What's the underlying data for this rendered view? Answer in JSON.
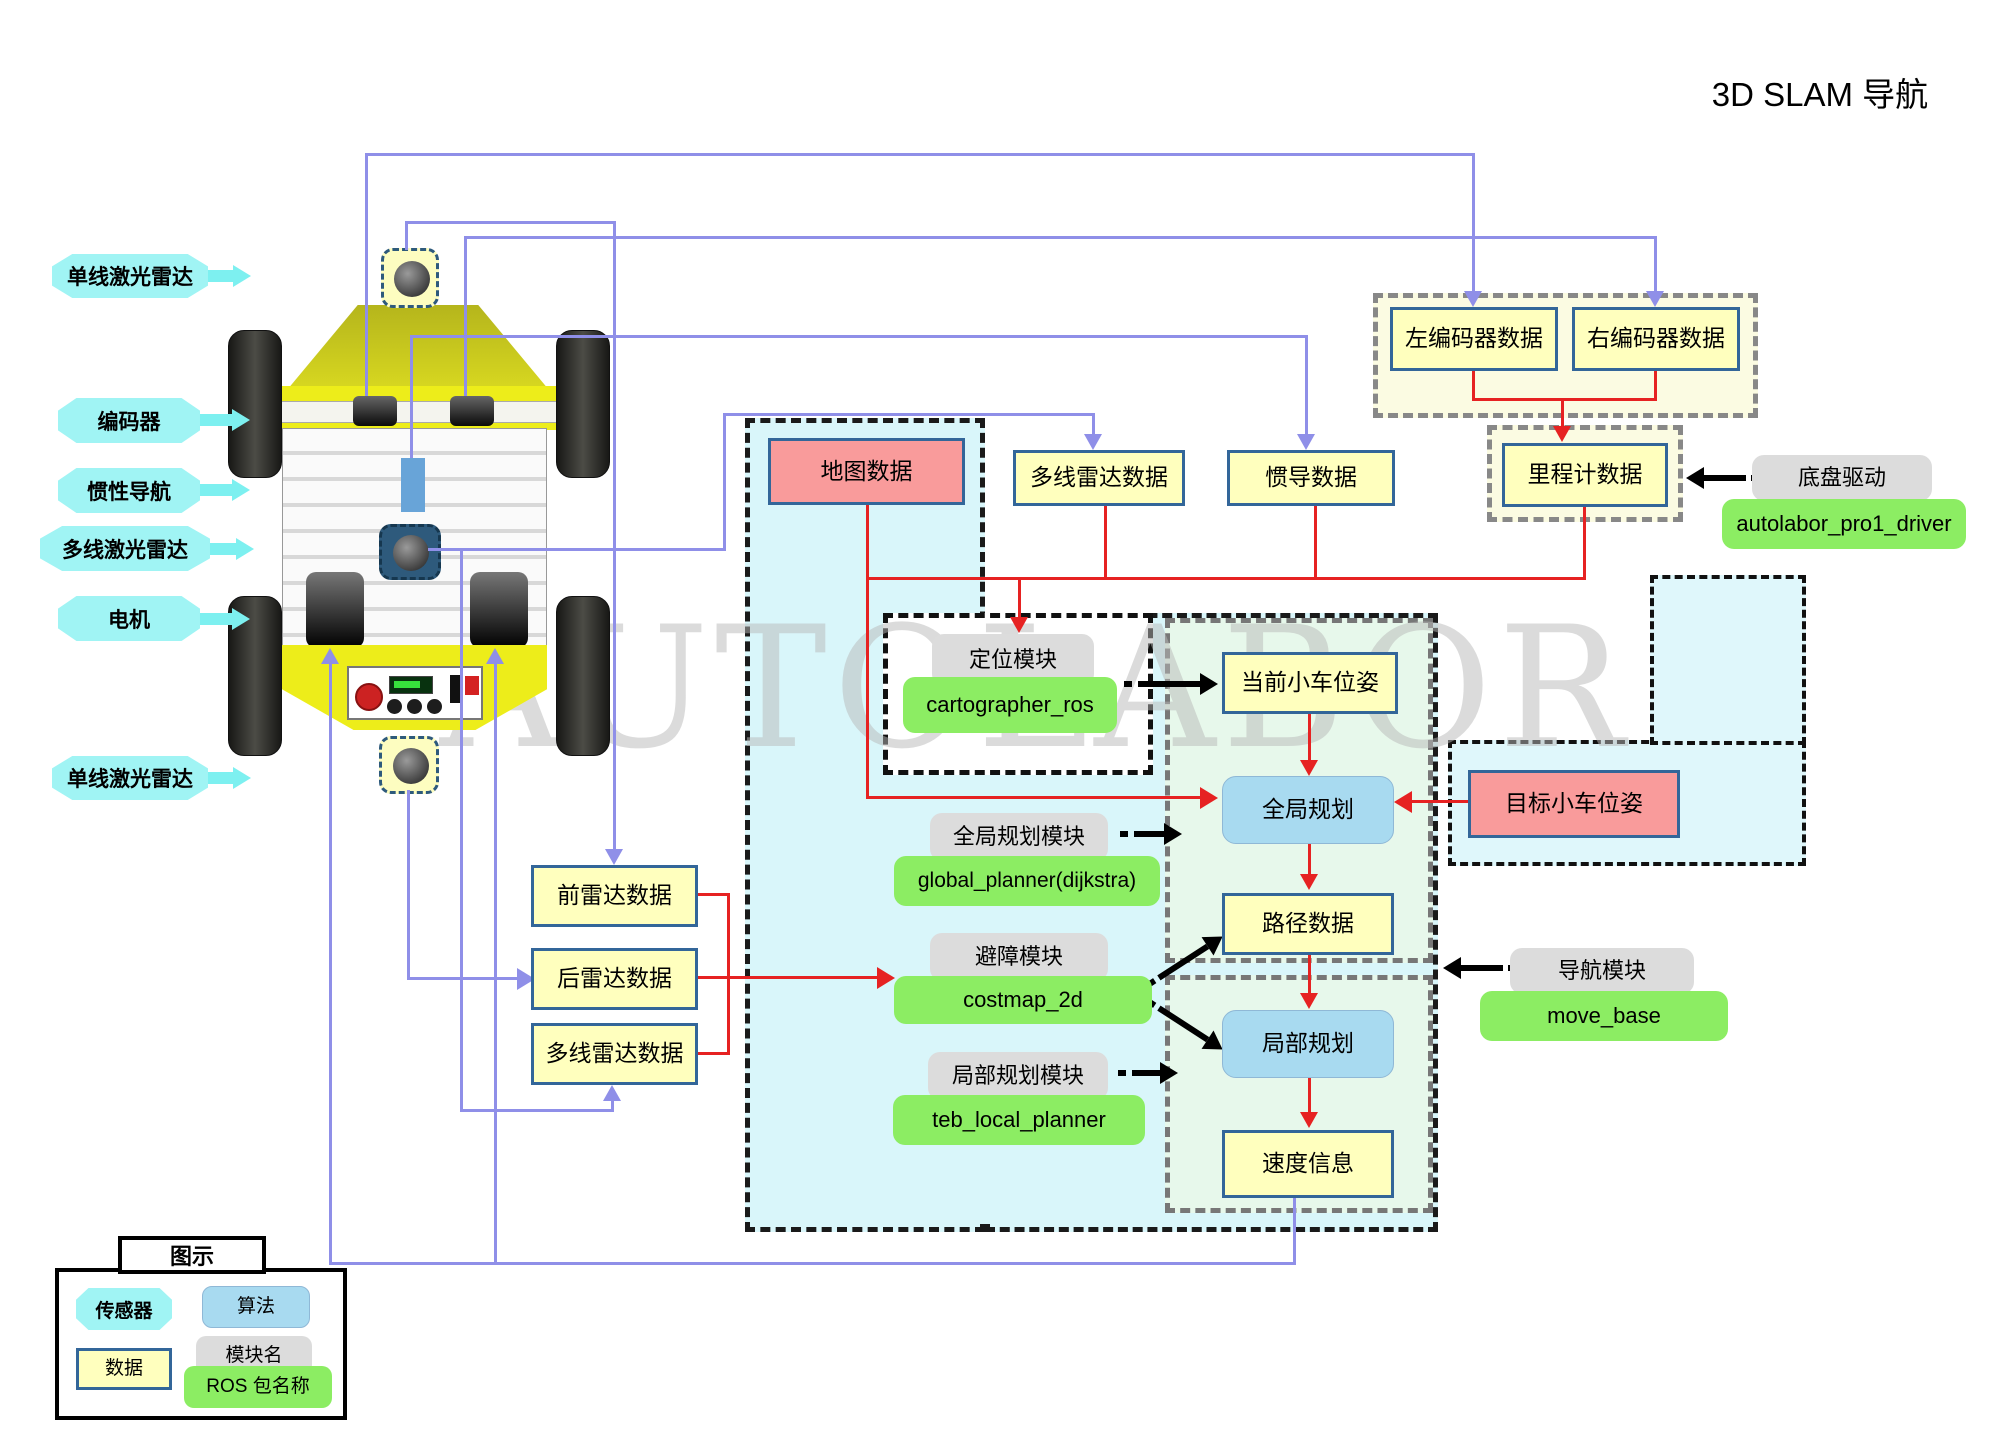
{
  "title": "3D SLAM  导航",
  "watermark": "AUTOLABOR",
  "colors": {
    "purple_line": "#8f8fe8",
    "red_line": "#e62222",
    "cyan_label": "#a0f4f4",
    "yellow_box": "#ffffbe",
    "pink_box": "#f99b9b",
    "algo_blue": "#a8daf0",
    "module_gray": "#dcdcdc",
    "ros_green": "#8ced63"
  },
  "sensor_labels": {
    "single_lidar_front": "单线激光雷达",
    "encoder": "编码器",
    "imu": "惯性导航",
    "multi_lidar": "多线激光雷达",
    "motor": "电机",
    "single_lidar_rear": "单线激光雷达"
  },
  "boxes": {
    "map": "地图数据",
    "multi_top": "多线雷达数据",
    "imu_data": "惯导数据",
    "left_enc": "左编码器数据",
    "right_enc": "右编码器数据",
    "odom": "里程计数据",
    "front_radar": "前雷达数据",
    "rear_radar": "后雷达数据",
    "multi_bottom": "多线雷达数据",
    "current_pose": "当前小车位姿",
    "goal_pose": "目标小车位姿",
    "path": "路径数据",
    "velocity": "速度信息"
  },
  "algos": {
    "global": "全局规划",
    "local": "局部规划"
  },
  "modules": {
    "loc": {
      "name": "定位模块",
      "pkg": "cartographer_ros"
    },
    "gp": {
      "name": "全局规划模块",
      "pkg": "global_planner(dijkstra)"
    },
    "ob": {
      "name": "避障模块",
      "pkg": "costmap_2d"
    },
    "lp": {
      "name": "局部规划模块",
      "pkg": "teb_local_planner"
    },
    "nav": {
      "name": "导航模块",
      "pkg": "move_base"
    },
    "drv": {
      "name": "底盘驱动",
      "pkg": "autolabor_pro1_driver"
    }
  },
  "legend": {
    "title": "图示",
    "sensor": "传感器",
    "algorithm": "算法",
    "data": "数据",
    "module": "模块名",
    "ros_pkg": "ROS 包名称"
  }
}
